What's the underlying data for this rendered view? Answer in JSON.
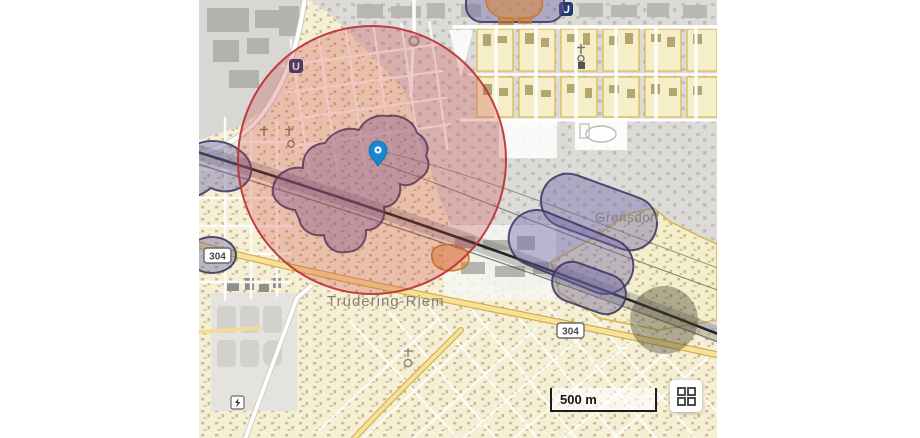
{
  "map": {
    "labels": {
      "suburb": "Trudering-Riem",
      "village": "Gronsdorf"
    },
    "road_badges": {
      "ref": "304"
    },
    "transit": {
      "ubahn_label": "U"
    },
    "marker": {
      "color": "#1787cf"
    },
    "overlays": {
      "selection_circle_stroke": "#b92f32",
      "selection_circle_fill": "rgba(205,62,62,0.27)",
      "zone_fill": "rgba(108,100,165,0.42)",
      "zone_stroke": "rgba(56,50,96,0.85)",
      "highlight_stroke": "#c67d2c"
    }
  },
  "controls": {
    "scale_label": "500 m",
    "layers_button_icon": "grid-icon"
  }
}
